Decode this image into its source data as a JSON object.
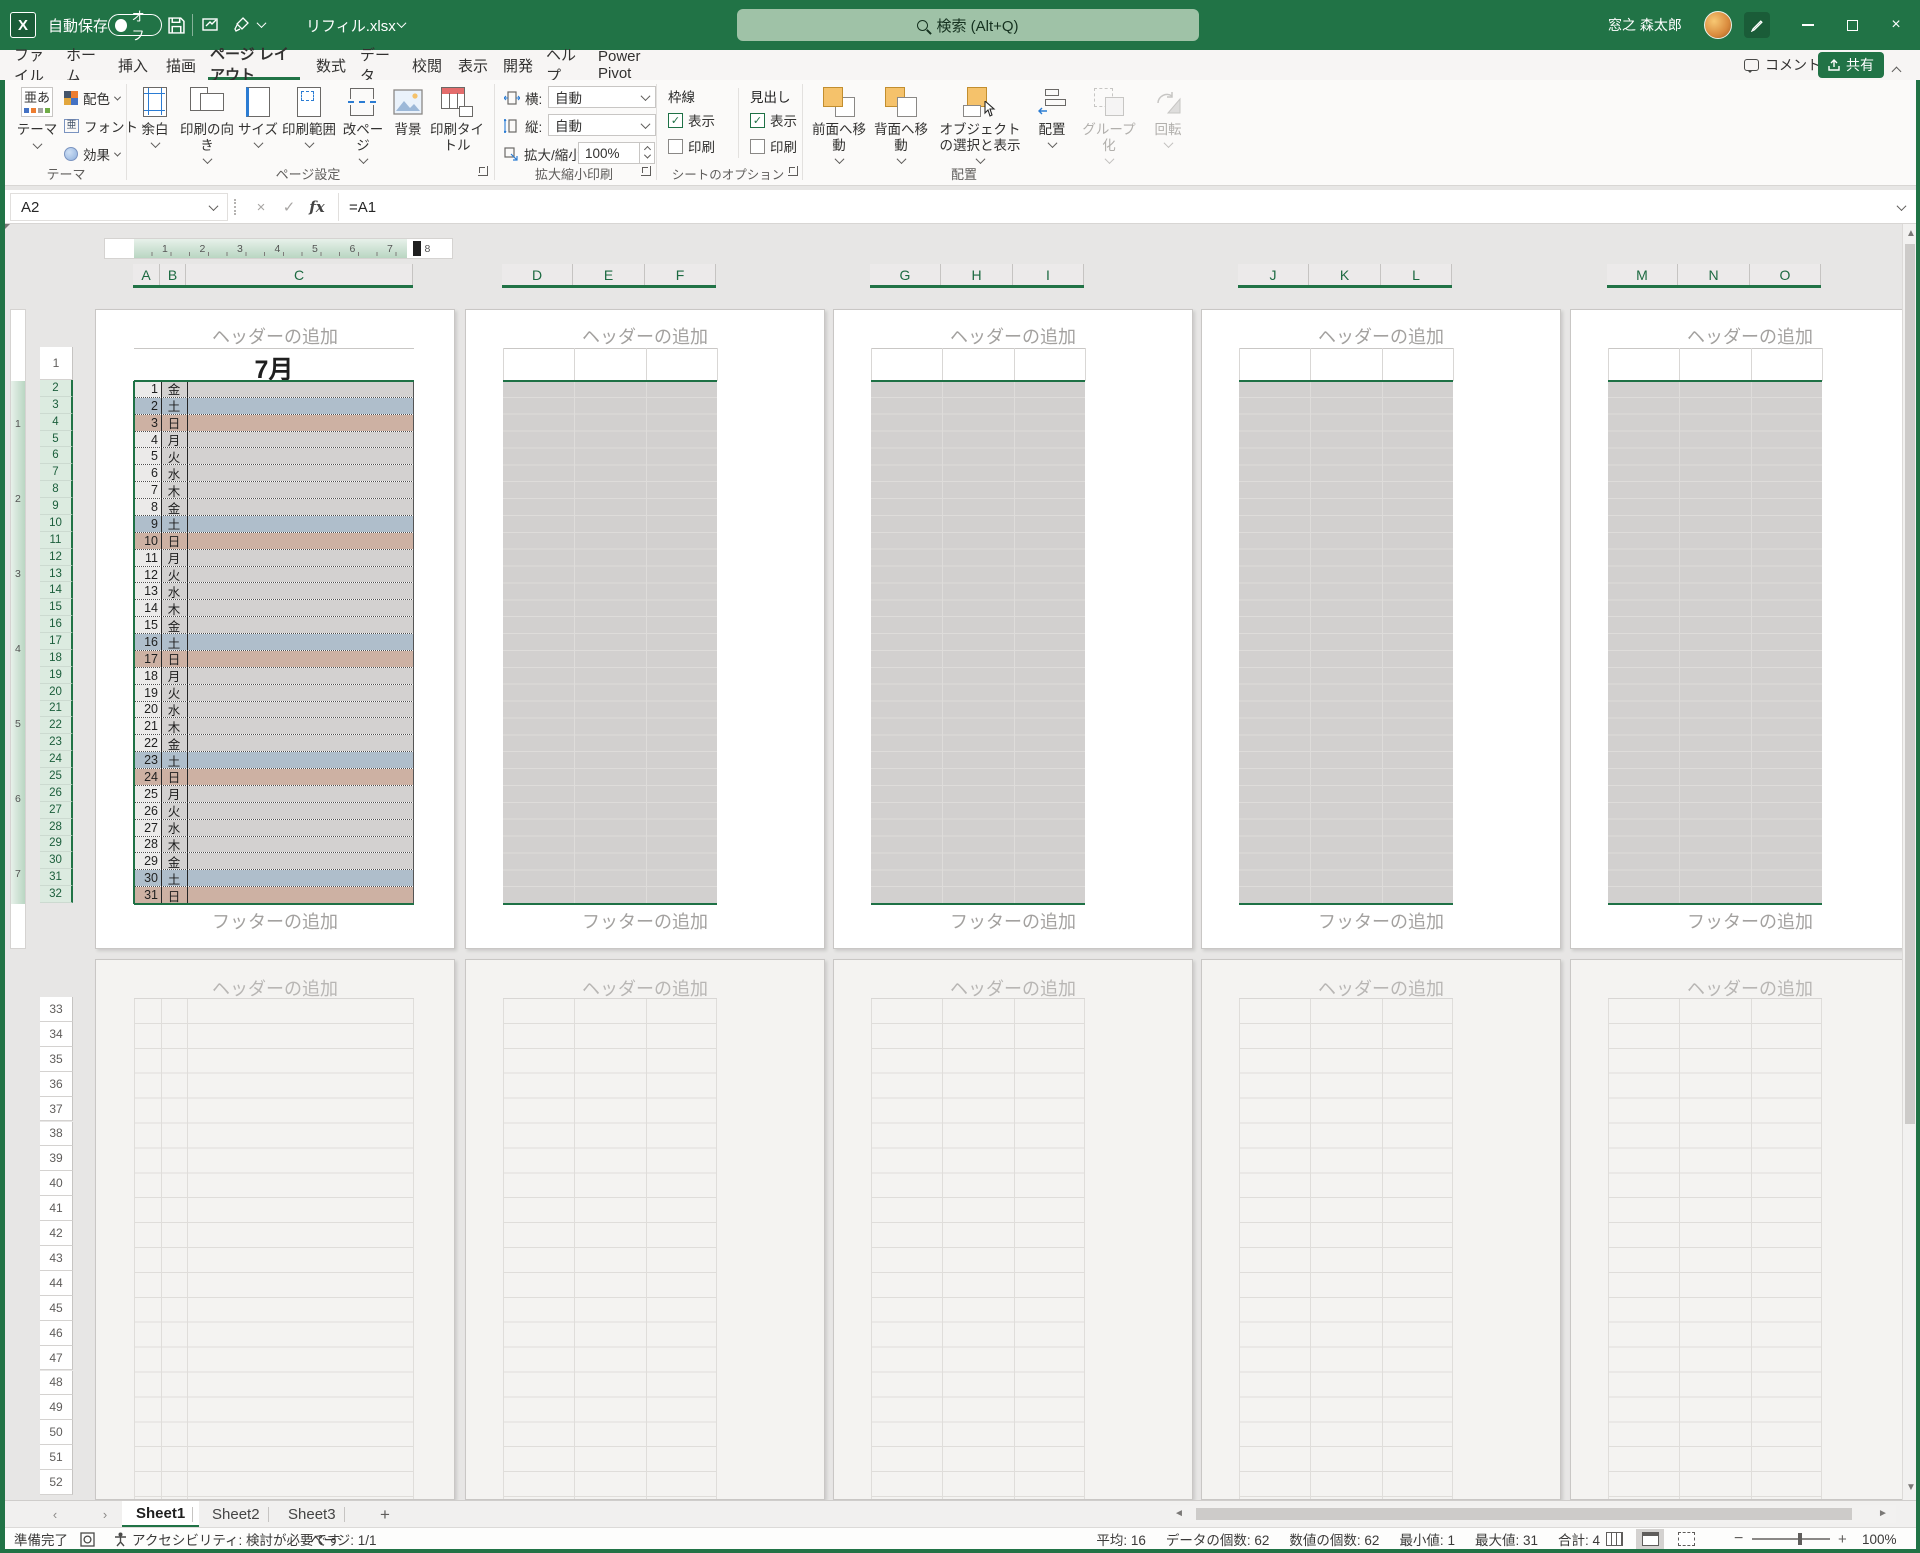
{
  "titlebar": {
    "autosave_label": "自動保存",
    "autosave_state": "オフ",
    "filename": "リフィル.xlsx",
    "search": "検索 (Alt+Q)",
    "user": "窓之 森太郎"
  },
  "menu": {
    "tabs": [
      "ファイル",
      "ホーム",
      "挿入",
      "描画",
      "ページ レイアウト",
      "数式",
      "データ",
      "校閲",
      "表示",
      "開発",
      "ヘルプ",
      "Power Pivot"
    ],
    "selected_index": 4,
    "comment": "コメント",
    "share": "共有"
  },
  "ribbon": {
    "theme": {
      "group": "テーマ",
      "main": "テーマ",
      "colors": "配色",
      "fonts": "フォント",
      "effects": "効果"
    },
    "page_setup": {
      "group": "ページ設定",
      "buttons": [
        "余白",
        "印刷の向き",
        "サイズ",
        "印刷範囲",
        "改ページ",
        "背景",
        "印刷タイトル"
      ]
    },
    "scale": {
      "group": "拡大縮小印刷",
      "width": "横:",
      "height": "縦:",
      "auto": "自動",
      "scale_label": "拡大/縮小:",
      "scale_value": "100%"
    },
    "sheet_opts": {
      "group": "シートのオプション",
      "gridlines": "枠線",
      "headings": "見出し",
      "view": "表示",
      "print": "印刷"
    },
    "arrange": {
      "group": "配置",
      "buttons": [
        "前面へ移動",
        "背面へ移動",
        "オブジェクトの選択と表示",
        "配置",
        "グループ化",
        "回転"
      ]
    }
  },
  "formula": {
    "name_box": "A2",
    "value": "=A1"
  },
  "sheet": {
    "column_groups": [
      [
        "A",
        "B",
        "C"
      ],
      [
        "D",
        "E",
        "F"
      ],
      [
        "G",
        "H",
        "I"
      ],
      [
        "J",
        "K",
        "L"
      ],
      [
        "M",
        "N",
        "O"
      ]
    ],
    "header_placeholder": "ヘッダーの追加",
    "footer_placeholder": "フッターの追加",
    "month_title": "7月",
    "ruler_numbers": [
      "1",
      "2",
      "3",
      "4",
      "5",
      "6",
      "7",
      "8"
    ],
    "vruler_numbers": [
      "1",
      "2",
      "3",
      "4",
      "5",
      "6",
      "7"
    ],
    "first_row_numbers": [
      1,
      2,
      3,
      4,
      5,
      6,
      7,
      8,
      9,
      10,
      11,
      12,
      13,
      14,
      15,
      16,
      17,
      18,
      19,
      20,
      21,
      22,
      23,
      24,
      25,
      26,
      27,
      28,
      29,
      30,
      31,
      32
    ],
    "second_row_numbers": [
      33,
      34,
      35,
      36,
      37,
      38,
      39,
      40,
      41,
      42,
      43,
      44,
      45,
      46,
      47,
      48,
      49,
      50,
      51,
      52
    ],
    "days": [
      {
        "n": 1,
        "d": "金"
      },
      {
        "n": 2,
        "d": "土"
      },
      {
        "n": 3,
        "d": "日"
      },
      {
        "n": 4,
        "d": "月"
      },
      {
        "n": 5,
        "d": "火"
      },
      {
        "n": 6,
        "d": "水"
      },
      {
        "n": 7,
        "d": "木"
      },
      {
        "n": 8,
        "d": "金"
      },
      {
        "n": 9,
        "d": "土"
      },
      {
        "n": 10,
        "d": "日"
      },
      {
        "n": 11,
        "d": "月"
      },
      {
        "n": 12,
        "d": "火"
      },
      {
        "n": 13,
        "d": "水"
      },
      {
        "n": 14,
        "d": "木"
      },
      {
        "n": 15,
        "d": "金"
      },
      {
        "n": 16,
        "d": "土"
      },
      {
        "n": 17,
        "d": "日"
      },
      {
        "n": 18,
        "d": "月"
      },
      {
        "n": 19,
        "d": "火"
      },
      {
        "n": 20,
        "d": "水"
      },
      {
        "n": 21,
        "d": "木"
      },
      {
        "n": 22,
        "d": "金"
      },
      {
        "n": 23,
        "d": "土"
      },
      {
        "n": 24,
        "d": "日"
      },
      {
        "n": 25,
        "d": "月"
      },
      {
        "n": 26,
        "d": "火"
      },
      {
        "n": 27,
        "d": "水"
      },
      {
        "n": 28,
        "d": "木"
      },
      {
        "n": 29,
        "d": "金"
      },
      {
        "n": 30,
        "d": "土"
      },
      {
        "n": 31,
        "d": "日"
      }
    ]
  },
  "sheet_tabs": {
    "tabs": [
      "Sheet1",
      "Sheet2",
      "Sheet3"
    ],
    "active": "Sheet1",
    "add_label": "+"
  },
  "status": {
    "ready": "準備完了",
    "accessibility": "アクセシビリティ: 検討が必要です",
    "page": "ページ: 1/1",
    "stats": [
      "平均: 16",
      "データの個数: 62",
      "数値の個数: 62",
      "最小値: 1",
      "最大値: 31",
      "合計: 4"
    ],
    "zoom": "100%"
  },
  "colors": {
    "accent": "#217346",
    "selection": "#1e7145",
    "saturday_fill": "#afbecb",
    "sunday_fill": "#cdb1a3",
    "weekday_fill": "#d3d1d0",
    "weekday_number_fill": "#ebeae9",
    "other_page_fill": "#d2d0cf"
  }
}
